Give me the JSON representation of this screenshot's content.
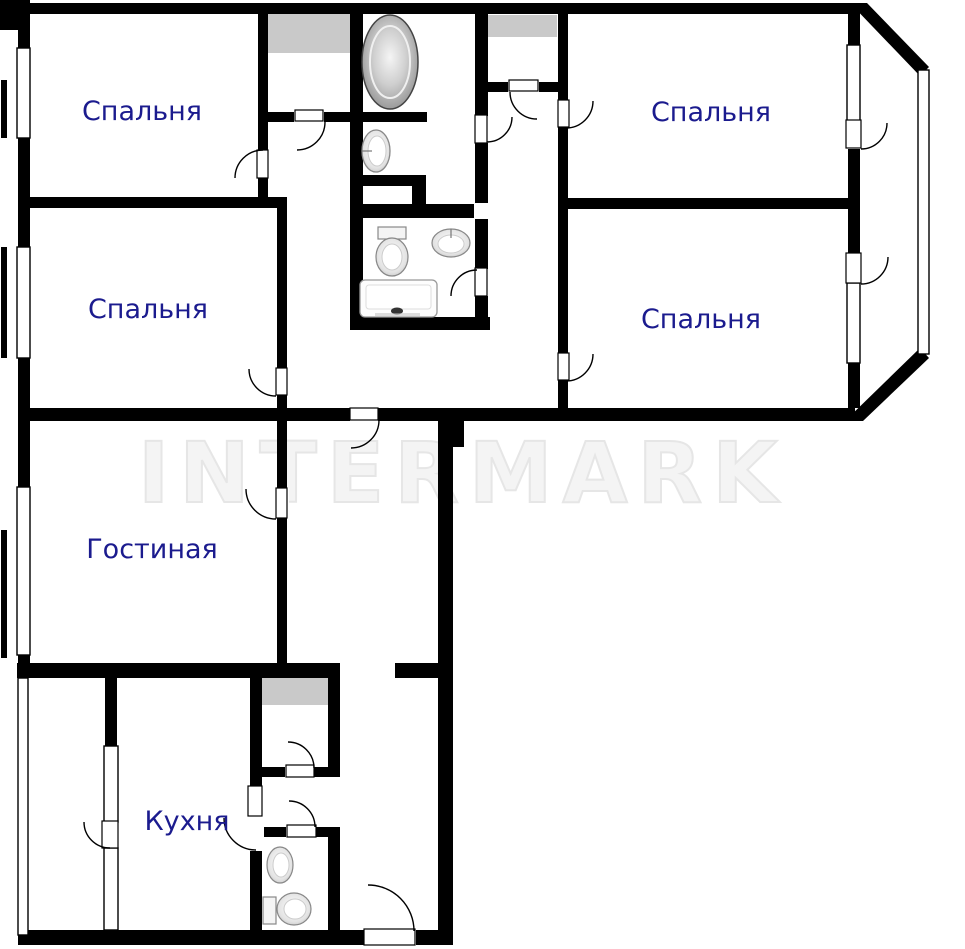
{
  "document": {
    "type": "apartment-floor-plan",
    "watermark_text": "INTERMARK"
  },
  "labels": {
    "bedroom1": "Спальня",
    "bedroom2": "Спальня",
    "bedroom3": "Спальня",
    "bedroom4": "Спальня",
    "living": "Гостиная",
    "kitchen": "Кухня"
  },
  "colors": {
    "wall": "#000000",
    "room_label": "#1b1b8e",
    "shaft_gray": "#c9c9c9",
    "watermark_gray": "#e6e6e6",
    "floor": "#ffffff"
  },
  "fixtures": [
    {
      "name": "bathtub",
      "room": "bathroom"
    },
    {
      "name": "washbasin",
      "room": "bathroom"
    },
    {
      "name": "toilet",
      "room": "wc"
    },
    {
      "name": "washbasin",
      "room": "wc"
    },
    {
      "name": "washing-machine",
      "room": "wc"
    },
    {
      "name": "washbasin",
      "room": "small-wc"
    },
    {
      "name": "toilet",
      "room": "small-wc"
    }
  ]
}
